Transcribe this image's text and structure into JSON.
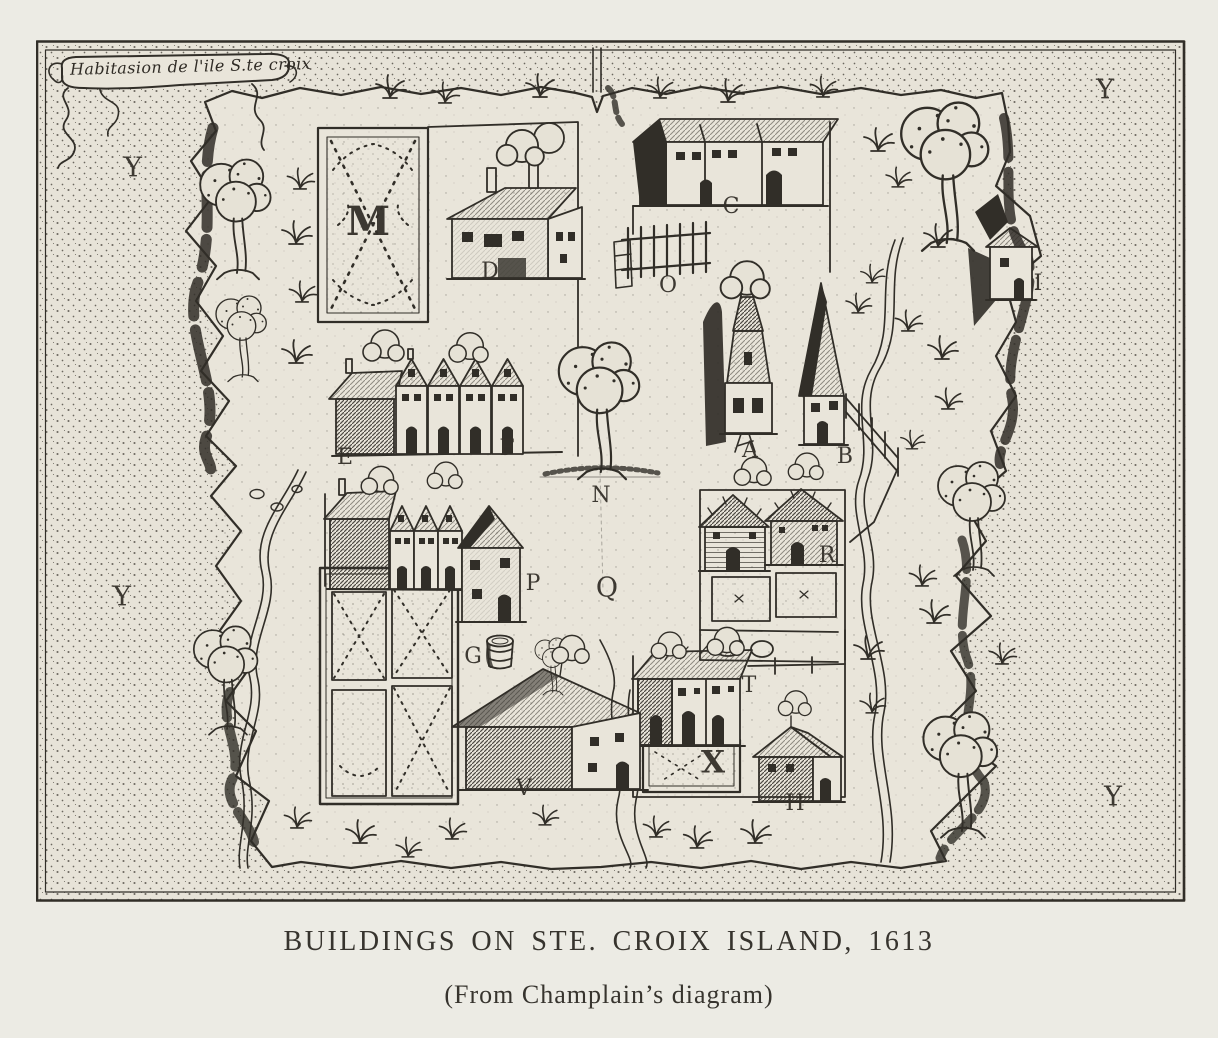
{
  "figure": {
    "cartouche_text": "Habitasion de l'ile S.te croix",
    "caption": {
      "title": "BUILDINGS ON STE. CROIX ISLAND, 1613",
      "subtitle": "(From Champlain’s diagram)"
    },
    "labels": [
      {
        "letter": "Y"
      },
      {
        "letter": "Y"
      },
      {
        "letter": "Y"
      },
      {
        "letter": "Y"
      },
      {
        "letter": "M"
      },
      {
        "letter": "D"
      },
      {
        "letter": "C"
      },
      {
        "letter": "O"
      },
      {
        "letter": "A"
      },
      {
        "letter": "B"
      },
      {
        "letter": "E"
      },
      {
        "letter": "F"
      },
      {
        "letter": "N"
      },
      {
        "letter": "Q"
      },
      {
        "letter": "P"
      },
      {
        "letter": "G"
      },
      {
        "letter": "V"
      },
      {
        "letter": "T"
      },
      {
        "letter": "X"
      },
      {
        "letter": "H"
      },
      {
        "letter": "R"
      },
      {
        "letter": "I"
      }
    ],
    "colors": {
      "paper": "#eceae2",
      "map_paper": "#e6e2d6",
      "ink": "#312e28"
    }
  }
}
